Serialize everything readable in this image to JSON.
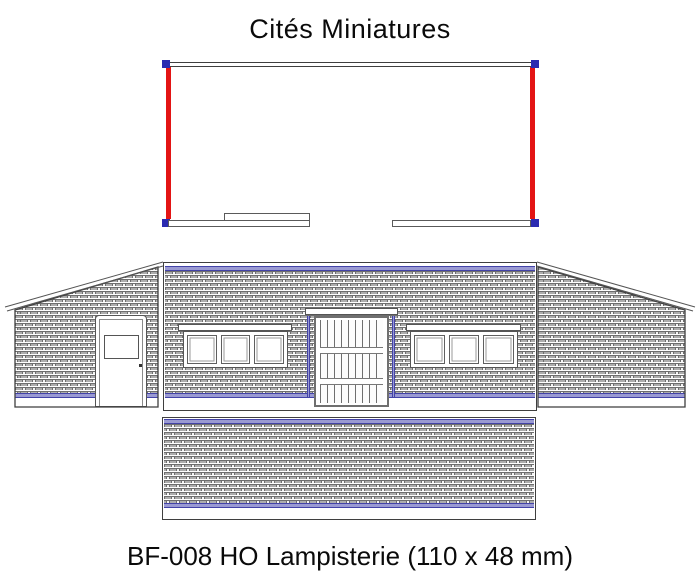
{
  "title": "Cités Miniatures",
  "caption": "BF-008 HO Lampisterie (110 x 48 mm)",
  "colors": {
    "red": "#e31414",
    "corner_blue": "#2a2ab0",
    "stripe_blue": "#9a9ad2",
    "stripe_blue_edge": "#4343a8",
    "brick_fill": "#adadad",
    "brick_edge": "#6f6f6f"
  }
}
